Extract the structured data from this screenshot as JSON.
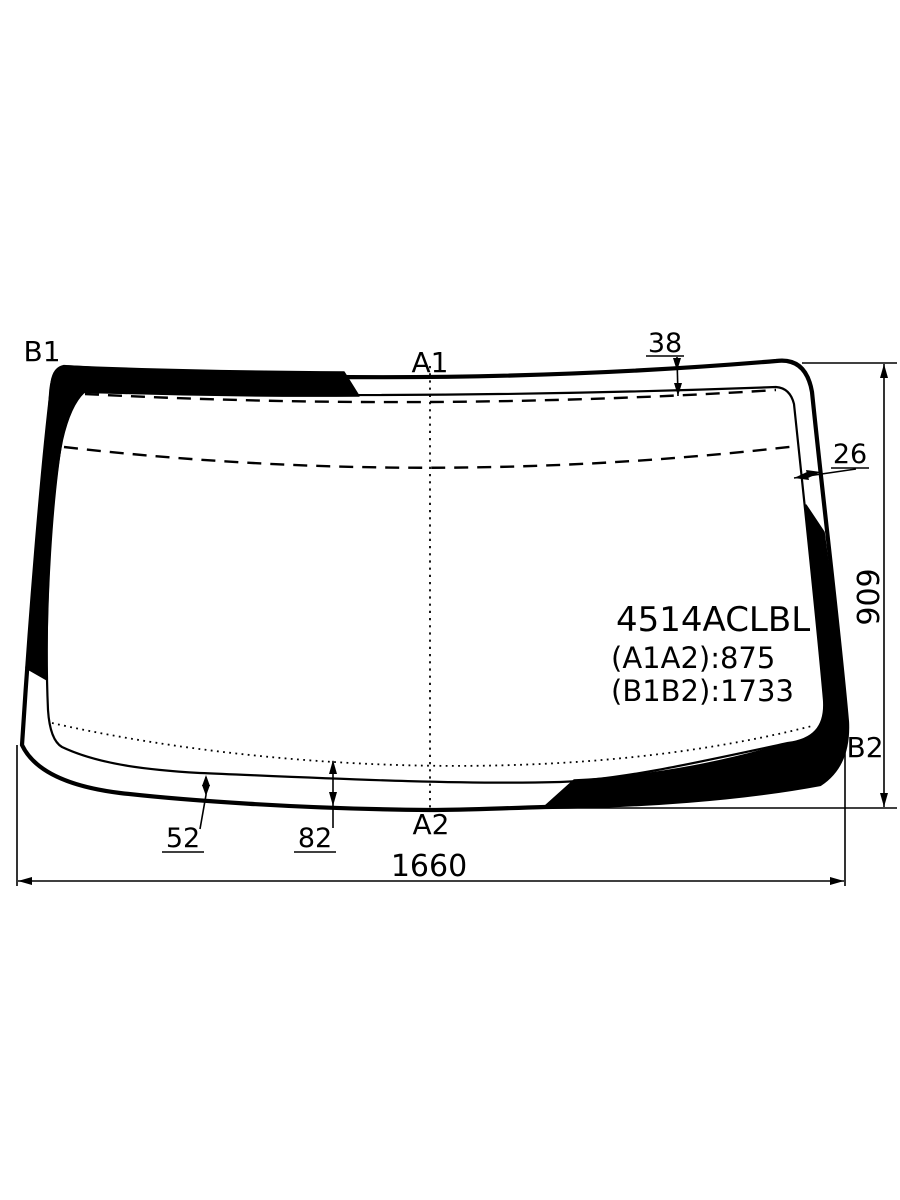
{
  "diagram": {
    "background": "#ffffff",
    "ink": "#000000",
    "part_number": "4514ACLBL",
    "spec_a1a2": "(A1A2):875",
    "spec_b1b2": "(B1B2):1733",
    "corner_labels": {
      "top_left": "B1",
      "top_center": "A1",
      "bottom_center": "A2",
      "bottom_right": "B2"
    },
    "dimensions": {
      "overall_width": "1660",
      "overall_height": "909",
      "top_band_offset": "38",
      "side_band_offset": "26",
      "bottom_inner_offset": "52",
      "bottom_outer_offset": "82"
    }
  }
}
